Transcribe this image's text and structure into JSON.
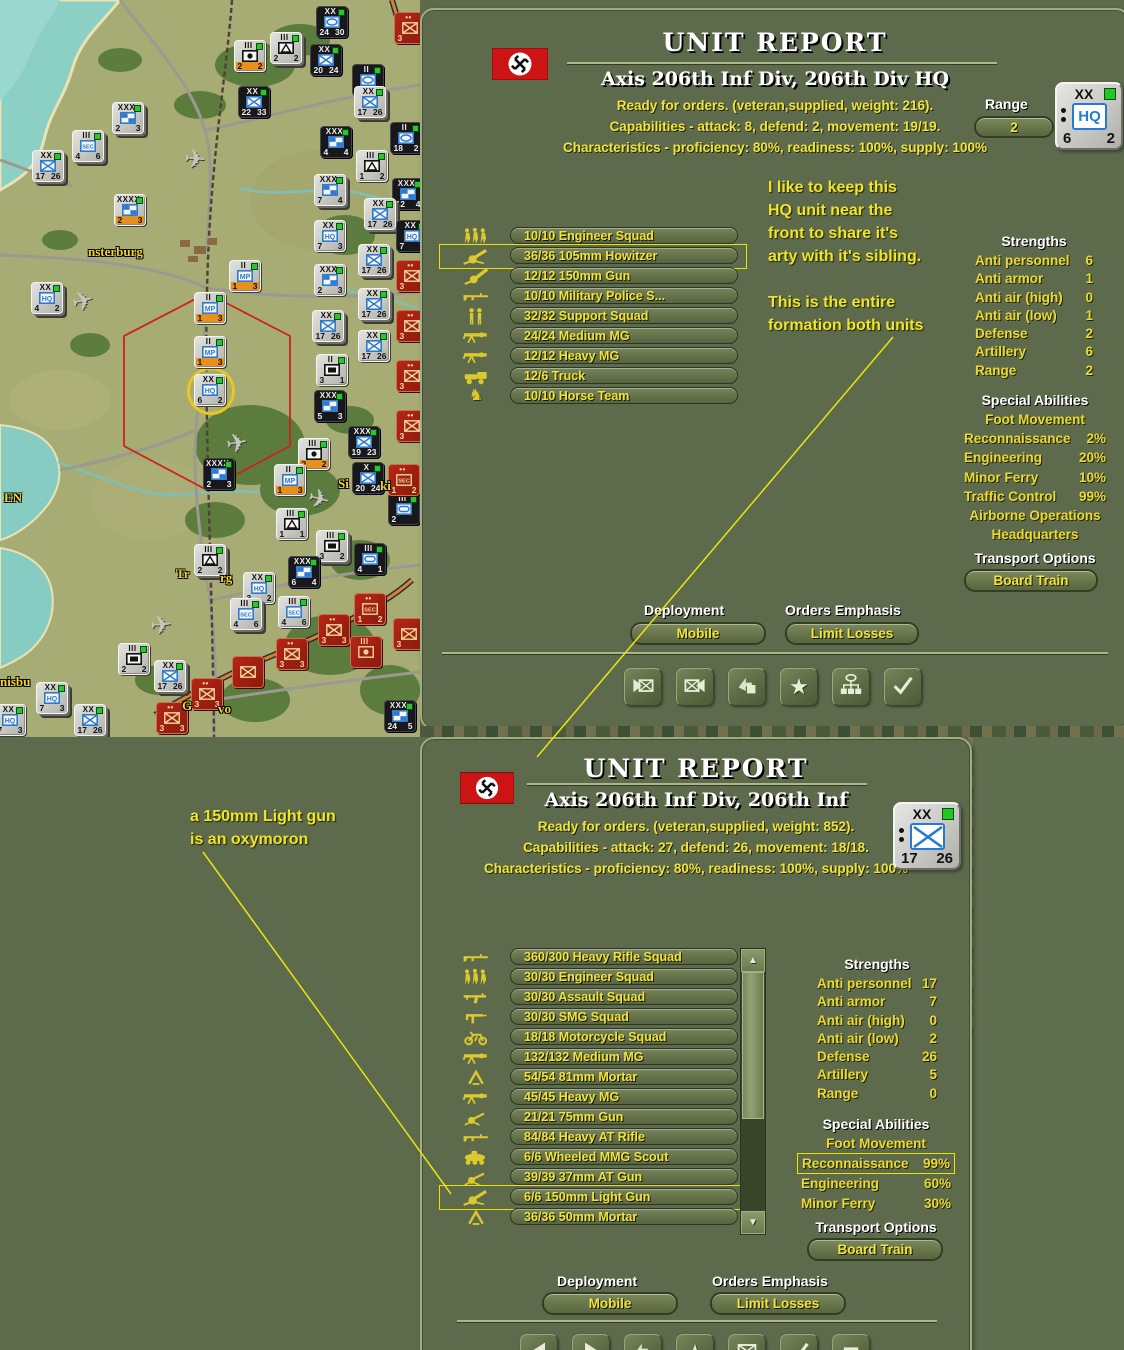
{
  "window": {
    "width": 1124,
    "height": 1350
  },
  "colors": {
    "panel": "#5d6b4c",
    "accent_yellow": "#f2e33b",
    "title_white": "#ffffff",
    "flag_red": "#cc1414",
    "highlight_box": "#ece400",
    "counter_gray": "#c9c9c5",
    "counter_black": "#18181a",
    "counter_red": "#a02418"
  },
  "notes": {
    "top": [
      "I like to keep this",
      "HQ unit near the",
      "front to share it's",
      "arty with it's sibling.",
      "",
      "This is the entire",
      "formation both units"
    ],
    "bottom": [
      "a 150mm Light gun",
      "is an oxymoron"
    ]
  },
  "connector_lines": [
    {
      "x1": 893,
      "y1": 337,
      "x2": 537,
      "y2": 757
    },
    {
      "x1": 203,
      "y1": 852,
      "x2": 451,
      "y2": 1194
    }
  ],
  "map": {
    "labels": [
      {
        "text": "nsterburg",
        "x": 88,
        "y": 244
      },
      {
        "text": "EN",
        "x": 4,
        "y": 490
      },
      {
        "text": "Tr",
        "x": 176,
        "y": 566
      },
      {
        "text": "rg",
        "x": 220,
        "y": 570
      },
      {
        "text": "nisbu",
        "x": 0,
        "y": 674
      },
      {
        "text": "G",
        "x": 182,
        "y": 698
      },
      {
        "text": "vo",
        "x": 218,
        "y": 701
      },
      {
        "text": "Si",
        "x": 338,
        "y": 476
      },
      {
        "text": "ki",
        "x": 380,
        "y": 478
      }
    ],
    "planes": [
      {
        "x": 72,
        "y": 288,
        "rot": -15
      },
      {
        "x": 184,
        "y": 146,
        "rot": 5
      },
      {
        "x": 226,
        "y": 430,
        "rot": -10
      },
      {
        "x": 308,
        "y": 486,
        "rot": 15
      },
      {
        "x": 150,
        "y": 612,
        "rot": -5
      }
    ],
    "counters": [
      {
        "x": 316,
        "y": 6,
        "v": "b",
        "top": "XX",
        "i": "oval",
        "l": "24",
        "r": "30"
      },
      {
        "x": 270,
        "y": 32,
        "v": "g",
        "top": "III",
        "i": "tent",
        "l": "2",
        "r": "2",
        "s": 1
      },
      {
        "x": 234,
        "y": 40,
        "v": "g",
        "top": "III",
        "i": "art",
        "l": "2",
        "r": "2",
        "o": 1
      },
      {
        "x": 310,
        "y": 44,
        "v": "b",
        "top": "XX",
        "i": "inf",
        "l": "20",
        "r": "24"
      },
      {
        "x": 352,
        "y": 64,
        "v": "b",
        "top": "II",
        "i": "oval",
        "l": "2",
        "r": "3"
      },
      {
        "x": 354,
        "y": 86,
        "v": "g",
        "top": "XX",
        "i": "inf",
        "l": "17",
        "r": "26",
        "s": 1
      },
      {
        "x": 390,
        "y": 122,
        "v": "b",
        "top": "II",
        "i": "oval",
        "l": "18",
        "r": "2"
      },
      {
        "x": 238,
        "y": 86,
        "v": "b",
        "top": "XX",
        "i": "inf",
        "l": "22",
        "r": "33"
      },
      {
        "x": 112,
        "y": 102,
        "v": "g",
        "top": "XXX",
        "i": "mix",
        "l": "2",
        "r": "3",
        "s": 1
      },
      {
        "x": 72,
        "y": 130,
        "v": "g",
        "top": "III",
        "i": "sec",
        "l": "4",
        "r": "6",
        "s": 1
      },
      {
        "x": 32,
        "y": 150,
        "v": "g",
        "top": "XX",
        "i": "inf",
        "l": "17",
        "r": "26",
        "s": 1
      },
      {
        "x": 320,
        "y": 126,
        "v": "b",
        "top": "XXX",
        "i": "mix",
        "l": "4",
        "r": "4"
      },
      {
        "x": 392,
        "y": 178,
        "v": "b",
        "top": "XXX",
        "i": "mix",
        "l": "12",
        "r": "4"
      },
      {
        "x": 356,
        "y": 150,
        "v": "g",
        "top": "III",
        "i": "tent",
        "l": "1",
        "r": "2"
      },
      {
        "x": 314,
        "y": 174,
        "v": "g",
        "top": "XXX",
        "i": "mix",
        "l": "7",
        "r": "4",
        "s": 1
      },
      {
        "x": 114,
        "y": 194,
        "v": "g",
        "top": "XXXX",
        "i": "mix",
        "l": "2",
        "r": "3",
        "o": 1
      },
      {
        "x": 364,
        "y": 198,
        "v": "g",
        "top": "XX",
        "i": "inf",
        "l": "17",
        "r": "26",
        "s": 1
      },
      {
        "x": 396,
        "y": 220,
        "v": "b",
        "top": "XX",
        "i": "hq",
        "l": "7",
        "r": ""
      },
      {
        "x": 314,
        "y": 220,
        "v": "g",
        "top": "XX",
        "i": "hq",
        "l": "7",
        "r": "3"
      },
      {
        "x": 358,
        "y": 244,
        "v": "g",
        "top": "XX",
        "i": "inf",
        "l": "17",
        "r": "26",
        "s": 1
      },
      {
        "x": 229,
        "y": 260,
        "v": "g",
        "top": "II",
        "i": "mp",
        "l": "1",
        "r": "3",
        "o": 1
      },
      {
        "x": 31,
        "y": 282,
        "v": "g",
        "top": "XX",
        "i": "hq",
        "l": "4",
        "r": "2",
        "s": 1
      },
      {
        "x": 314,
        "y": 264,
        "v": "g",
        "top": "XXX",
        "i": "mix",
        "l": "2",
        "r": "3"
      },
      {
        "x": 358,
        "y": 288,
        "v": "g",
        "top": "XX",
        "i": "inf",
        "l": "17",
        "r": "26",
        "s": 1
      },
      {
        "x": 194,
        "y": 292,
        "v": "g",
        "top": "II",
        "i": "mp",
        "l": "1",
        "r": "3",
        "o": 1
      },
      {
        "x": 312,
        "y": 310,
        "v": "g",
        "top": "XX",
        "i": "inf",
        "l": "17",
        "r": "26",
        "s": 1
      },
      {
        "x": 194,
        "y": 336,
        "v": "g",
        "top": "II",
        "i": "mp",
        "l": "1",
        "r": "3",
        "o": 1
      },
      {
        "x": 316,
        "y": 354,
        "v": "g",
        "top": "II",
        "i": "rect",
        "l": "3",
        "r": "1"
      },
      {
        "x": 358,
        "y": 330,
        "v": "g",
        "top": "XX",
        "i": "inf",
        "l": "17",
        "r": "26"
      },
      {
        "x": 194,
        "y": 374,
        "v": "g",
        "top": "XX",
        "i": "hq",
        "l": "6",
        "r": "2",
        "sel": 1
      },
      {
        "x": 314,
        "y": 390,
        "v": "b",
        "top": "XXX",
        "i": "mix",
        "l": "5",
        "r": "3"
      },
      {
        "x": 348,
        "y": 426,
        "v": "b",
        "top": "XXX",
        "i": "inf",
        "l": "19",
        "r": "23"
      },
      {
        "x": 352,
        "y": 462,
        "v": "b",
        "top": "X",
        "i": "inf",
        "l": "20",
        "r": "24"
      },
      {
        "x": 298,
        "y": 438,
        "v": "g",
        "top": "III",
        "i": "art",
        "l": "2",
        "r": "2",
        "o": 1
      },
      {
        "x": 274,
        "y": 464,
        "v": "g",
        "top": "II",
        "i": "mp",
        "l": "1",
        "r": "3",
        "o": 1
      },
      {
        "x": 203,
        "y": 458,
        "v": "b",
        "top": "XXXX",
        "i": "mix",
        "l": "2",
        "r": "3"
      },
      {
        "x": 276,
        "y": 508,
        "v": "g",
        "top": "III",
        "i": "tent",
        "l": "1",
        "r": "1"
      },
      {
        "x": 316,
        "y": 530,
        "v": "g",
        "top": "III",
        "i": "rect",
        "l": "3",
        "r": "2",
        "s": 1
      },
      {
        "x": 354,
        "y": 543,
        "v": "b",
        "top": "III",
        "i": "oval2",
        "l": "4",
        "r": "1"
      },
      {
        "x": 288,
        "y": 556,
        "v": "b",
        "top": "XXX",
        "i": "mix",
        "l": "6",
        "r": "4"
      },
      {
        "x": 194,
        "y": 544,
        "v": "g",
        "top": "III",
        "i": "tent",
        "l": "2",
        "r": "2",
        "s": 1
      },
      {
        "x": 243,
        "y": 572,
        "v": "g",
        "top": "XX",
        "i": "hq",
        "l": "3",
        "r": "2"
      },
      {
        "x": 230,
        "y": 598,
        "v": "g",
        "top": "III",
        "i": "sec",
        "l": "4",
        "r": "6",
        "s": 1
      },
      {
        "x": 278,
        "y": 596,
        "v": "g",
        "top": "III",
        "i": "sec",
        "l": "4",
        "r": "6"
      },
      {
        "x": 388,
        "y": 493,
        "v": "b",
        "top": "III",
        "i": "oval2",
        "l": "2",
        "r": ""
      },
      {
        "x": 118,
        "y": 643,
        "v": "g",
        "top": "III",
        "i": "rect",
        "l": "2",
        "r": "2"
      },
      {
        "x": 154,
        "y": 660,
        "v": "g",
        "top": "XX",
        "i": "inf",
        "l": "17",
        "r": "26",
        "s": 1
      },
      {
        "x": 36,
        "y": 682,
        "v": "g",
        "top": "XX",
        "i": "hq",
        "l": "7",
        "r": "3",
        "s": 1
      },
      {
        "x": -6,
        "y": 704,
        "v": "g",
        "top": "XX",
        "i": "hq",
        "l": "7",
        "r": "3"
      },
      {
        "x": 74,
        "y": 704,
        "v": "g",
        "top": "XX",
        "i": "inf",
        "l": "17",
        "r": "26",
        "s": 1
      },
      {
        "x": 354,
        "y": 593,
        "v": "r",
        "top": "••",
        "i": "secR",
        "l": "1",
        "r": "2"
      },
      {
        "x": 318,
        "y": 614,
        "v": "r",
        "top": "••",
        "i": "infR",
        "l": "3",
        "r": "3"
      },
      {
        "x": 276,
        "y": 638,
        "v": "r",
        "top": "••",
        "i": "infR",
        "l": "3",
        "r": "3"
      },
      {
        "x": 350,
        "y": 636,
        "v": "r",
        "top": "III",
        "i": "artR",
        "l": "",
        "r": ""
      },
      {
        "x": 232,
        "y": 656,
        "v": "r",
        "top": "",
        "i": "infR",
        "l": "",
        "r": ""
      },
      {
        "x": 191,
        "y": 678,
        "v": "r",
        "top": "••",
        "i": "infR",
        "l": "3",
        "r": "3"
      },
      {
        "x": 156,
        "y": 702,
        "v": "r",
        "top": "••",
        "i": "infR",
        "l": "3",
        "r": "3"
      },
      {
        "x": 393,
        "y": 618,
        "v": "r",
        "top": "",
        "i": "infR",
        "l": "3",
        "r": ""
      },
      {
        "x": 394,
        "y": 12,
        "v": "r",
        "top": "••",
        "i": "infR",
        "l": "3",
        "r": ""
      },
      {
        "x": 396,
        "y": 260,
        "v": "r",
        "top": "••",
        "i": "infR",
        "l": "3",
        "r": ""
      },
      {
        "x": 396,
        "y": 310,
        "v": "r",
        "top": "••",
        "i": "infR",
        "l": "3",
        "r": ""
      },
      {
        "x": 396,
        "y": 360,
        "v": "r",
        "top": "••",
        "i": "infR",
        "l": "3",
        "r": ""
      },
      {
        "x": 396,
        "y": 410,
        "v": "r",
        "top": "••",
        "i": "infR",
        "l": "3",
        "r": ""
      },
      {
        "x": 388,
        "y": 464,
        "v": "r",
        "top": "••",
        "i": "secR",
        "l": "1",
        "r": "2"
      },
      {
        "x": 384,
        "y": 700,
        "v": "b",
        "top": "XXX",
        "i": "mix",
        "l": "24",
        "r": "5"
      }
    ]
  },
  "top_panel": {
    "title": "UNIT REPORT",
    "subtitle": "Axis 206th Inf Div,  206th Div HQ",
    "status_line": "Ready for orders. (veteran,supplied, weight: 216).",
    "capabilities_line": "Capabilities - attack: 8, defend: 2, movement: 19/19.",
    "characteristics_line": "Characteristics - proficiency: 80%, readiness: 100%, supply: 100%",
    "range_label": "Range",
    "range_value": "2",
    "counter": {
      "size": "XX",
      "symbol": "HQ",
      "bottom_left": "6",
      "bottom_right": "2"
    },
    "units": [
      {
        "label": "10/10 Engineer Squad",
        "icon": "squad-walking-icon"
      },
      {
        "label": "36/36 105mm Howitzer",
        "icon": "howitzer-icon",
        "highlighted": true
      },
      {
        "label": "12/12 150mm Gun",
        "icon": "gun-icon"
      },
      {
        "label": "10/10 Military Police S...",
        "icon": "rifle-icon"
      },
      {
        "label": "32/32 Support Squad",
        "icon": "squad-standing-icon"
      },
      {
        "label": "24/24 Medium MG",
        "icon": "mg-icon"
      },
      {
        "label": "12/12 Heavy MG",
        "icon": "mg-icon"
      },
      {
        "label": "12/6 Truck",
        "icon": "truck-icon"
      },
      {
        "label": "10/10 Horse Team",
        "icon": "horse-icon"
      }
    ],
    "strengths_title": "Strengths",
    "strengths": [
      {
        "label": "Anti personnel",
        "value": "6"
      },
      {
        "label": "Anti armor",
        "value": "1"
      },
      {
        "label": "Anti air (high)",
        "value": "0"
      },
      {
        "label": "Anti air (low)",
        "value": "1"
      },
      {
        "label": "Defense",
        "value": "2"
      },
      {
        "label": "Artillery",
        "value": "6"
      },
      {
        "label": "Range",
        "value": "2"
      }
    ],
    "special_title": "Special Abilities",
    "special": [
      {
        "label": "Foot Movement"
      },
      {
        "label": "Reconnaissance",
        "value": "2%"
      },
      {
        "label": "Engineering",
        "value": "20%"
      },
      {
        "label": "Minor Ferry",
        "value": "10%"
      },
      {
        "label": "Traffic Control",
        "value": "99%"
      },
      {
        "label": "Airborne Operations"
      },
      {
        "label": "Headquarters"
      }
    ],
    "transport_title": "Transport Options",
    "transport_button": "Board Train",
    "deployment_label": "Deployment",
    "deployment_value": "Mobile",
    "orders_label": "Orders Emphasis",
    "orders_value": "Limit Losses",
    "action_icons": [
      "unit-left-icon",
      "unit-right-icon",
      "bent-arrow-icon",
      "star-icon",
      "org-chart-icon",
      "check-icon"
    ]
  },
  "bottom_panel": {
    "title": "UNIT REPORT",
    "subtitle": "Axis 206th Inf Div, 206th Inf",
    "status_line": "Ready for orders. (veteran,supplied, weight: 852).",
    "capabilities_line": "Capabilities - attack: 27, defend: 26, movement: 18/18.",
    "characteristics_line": "Characteristics - proficiency: 80%, readiness: 100%, supply: 100%",
    "counter": {
      "size": "XX",
      "symbol": "X",
      "bottom_left": "17",
      "bottom_right": "26"
    },
    "units": [
      {
        "label": "360/300 Heavy Rifle Squad",
        "icon": "rifle-icon"
      },
      {
        "label": "30/30 Engineer Squad",
        "icon": "squad-walking-icon"
      },
      {
        "label": "30/30 Assault Squad",
        "icon": "assault-icon"
      },
      {
        "label": "30/30 SMG Squad",
        "icon": "smg-icon"
      },
      {
        "label": "18/18 Motorcycle Squad",
        "icon": "moto-icon"
      },
      {
        "label": "132/132 Medium MG",
        "icon": "mg-icon"
      },
      {
        "label": "54/54 81mm Mortar",
        "icon": "mortar-icon"
      },
      {
        "label": "45/45 Heavy MG",
        "icon": "mg-icon"
      },
      {
        "label": "21/21 75mm Gun",
        "icon": "atgun-icon"
      },
      {
        "label": "84/84 Heavy AT Rifle",
        "icon": "rifle-icon"
      },
      {
        "label": "6/6 Wheeled MMG Scout",
        "icon": "scout-car-icon"
      },
      {
        "label": "39/39 37mm AT Gun",
        "icon": "atgun-icon"
      },
      {
        "label": "6/6 150mm Light Gun",
        "icon": "howitzer-icon",
        "highlighted": true
      },
      {
        "label": "36/36 50mm Mortar",
        "icon": "mortar-icon"
      }
    ],
    "scrollbar": {
      "up": "▲",
      "down": "▼"
    },
    "strengths_title": "Strengths",
    "strengths": [
      {
        "label": "Anti personnel",
        "value": "17"
      },
      {
        "label": "Anti armor",
        "value": "7"
      },
      {
        "label": "Anti air (high)",
        "value": "0"
      },
      {
        "label": "Anti air (low)",
        "value": "2"
      },
      {
        "label": "Defense",
        "value": "26"
      },
      {
        "label": "Artillery",
        "value": "5"
      },
      {
        "label": "Range",
        "value": "0"
      }
    ],
    "special_title": "Special Abilities",
    "special": [
      {
        "label": "Foot Movement"
      },
      {
        "label": "Reconnaissance",
        "value": "99%",
        "boxed": true
      },
      {
        "label": "Engineering",
        "value": "60%"
      },
      {
        "label": "Minor Ferry",
        "value": "30%"
      }
    ],
    "transport_title": "Transport Options",
    "transport_button": "Board Train",
    "deployment_label": "Deployment",
    "deployment_value": "Mobile",
    "orders_label": "Orders Emphasis",
    "orders_value": "Limit Losses",
    "action_icons": [
      "left-tri-icon",
      "right-tri-icon",
      "bent-arrow-icon",
      "star-icon",
      "unit-box-icon",
      "check-icon",
      "rect-icon"
    ]
  }
}
